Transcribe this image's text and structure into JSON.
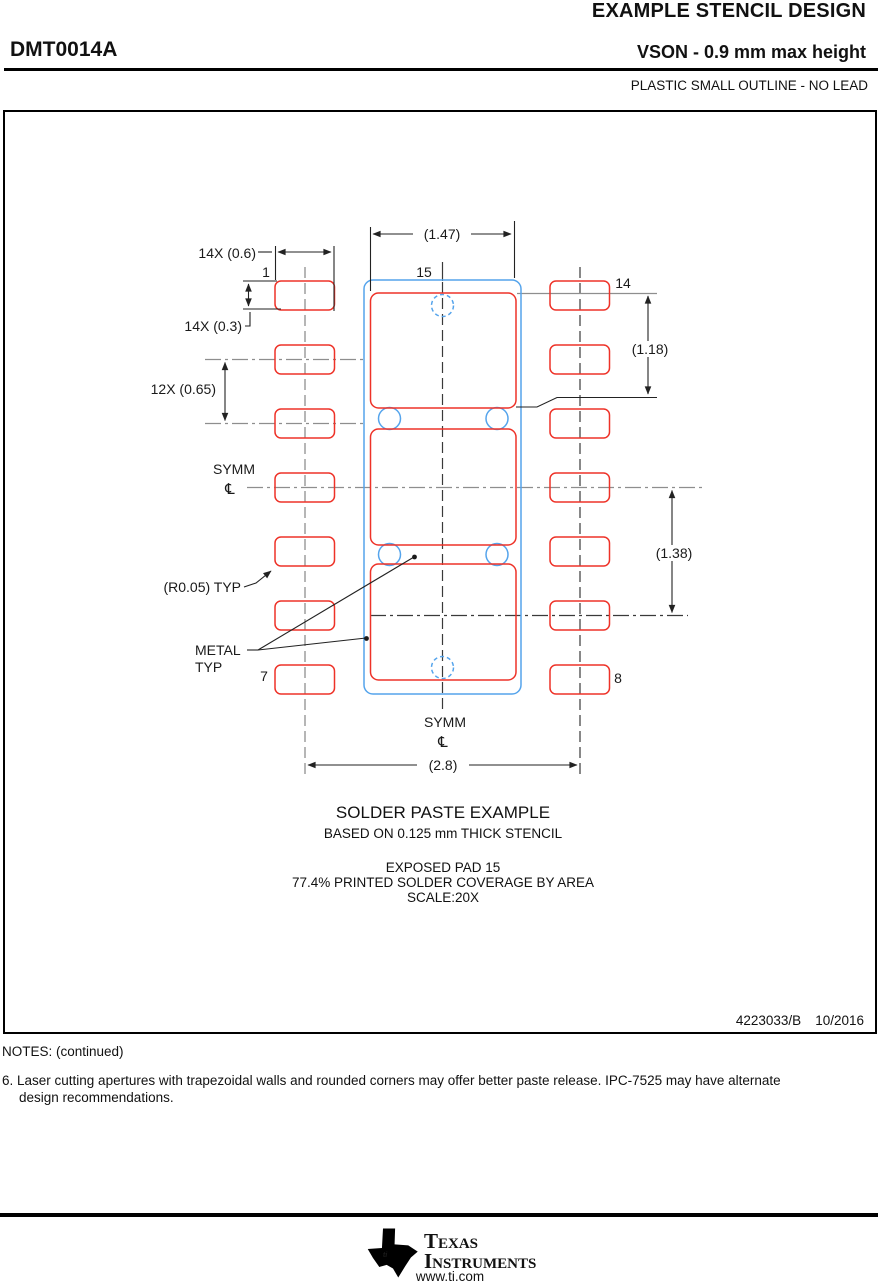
{
  "header": {
    "title": "EXAMPLE STENCIL DESIGN",
    "part_number": "DMT0014A",
    "package_line": "VSON - 0.9 mm max height",
    "package_subtitle": "PLASTIC SMALL OUTLINE - NO LEAD"
  },
  "drawing": {
    "dimensions": {
      "pad_width": "14X (0.6)",
      "pad_height": "14X (0.3)",
      "pad_pitch": "12X (0.65)",
      "epad_width": "(1.47)",
      "epad_segment_height": "(1.18)",
      "epad_lower_span": "(1.38)",
      "row_to_row": "(2.8)",
      "corner_radius": "(R0.05) TYP"
    },
    "labels": {
      "symm_left": "SYMM",
      "symm_bottom": "SYMM",
      "centerline_symbol": "℄",
      "metal_line1": "METAL",
      "metal_line2": "TYP"
    },
    "pins": {
      "pin1": "1",
      "pin7": "7",
      "pin8": "8",
      "pin14": "14",
      "pin15": "15"
    }
  },
  "caption": {
    "line1": "SOLDER PASTE EXAMPLE",
    "line2": "BASED ON 0.125 mm THICK STENCIL",
    "line3": "EXPOSED PAD 15",
    "line4": "77.4% PRINTED SOLDER COVERAGE BY AREA",
    "line5": "SCALE:20X"
  },
  "doc_ref": {
    "number": "4223033/B",
    "date": "10/2016"
  },
  "notes": {
    "heading": "NOTES: (continued)",
    "note6_line1": "6. Laser cutting apertures with trapezoidal walls and rounded corners may offer better paste release. IPC-7525 may have alternate",
    "note6_line2": "design recommendations."
  },
  "footer": {
    "brand_line1": "Texas",
    "brand_line2": "Instruments",
    "logo_letters": "ti",
    "url": "www.ti.com"
  },
  "colors": {
    "paste_red": "#ee3228",
    "pad_blue": "#55a4ec",
    "centerline_gray": "#8e8e8e",
    "line_black": "#222222"
  }
}
